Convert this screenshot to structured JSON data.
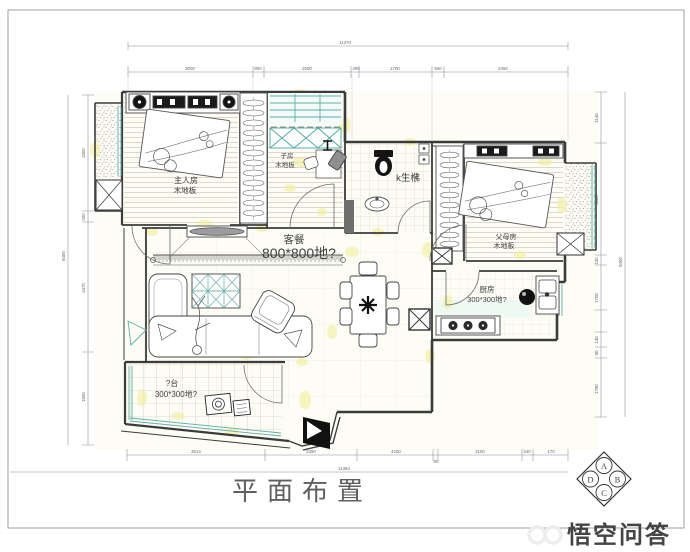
{
  "page": {
    "title_block": {
      "drawing_title": "平面布置"
    },
    "watermark": "悟空问答"
  },
  "rooms": {
    "master": {
      "name": "主人房",
      "floor": "木地板"
    },
    "kids": {
      "name": "子房",
      "floor": "木地板"
    },
    "bathroom": {
      "name": "k生梻"
    },
    "parents": {
      "name": "父母房",
      "floor": "木地板"
    },
    "living_dining": {
      "name": "客餐",
      "floor": "800*800地?"
    },
    "kitchen": {
      "name": "厨房",
      "floor": "300*300地?"
    },
    "balcony": {
      "name": "?台",
      "floor": "300*300地?"
    }
  },
  "dimensions": {
    "top": {
      "total": "11370",
      "segments": [
        "3000",
        "800",
        "2500",
        "300",
        "1700",
        "940",
        "2450"
      ]
    },
    "bottom": {
      "total": "11384",
      "segments": [
        "3514",
        "2390",
        "4200",
        "90",
        "2150",
        "240",
        "170"
      ]
    },
    "left": {
      "total": "8400",
      "segments": [
        "3300",
        "200",
        "3470",
        "1800"
      ]
    },
    "right": {
      "total": "8400",
      "segments": [
        "1140",
        "3000",
        "130",
        "1700",
        "140",
        "90",
        "1780"
      ]
    }
  },
  "reference_symbol": {
    "top": "A",
    "right": "B",
    "bottom": "C",
    "left": "D"
  },
  "colors": {
    "title_teal": "#49a9a1",
    "window_teal": "#5fb0a9",
    "highlight_yellow": "#f3ef9a",
    "wall_dark": "#3b3b3b",
    "watermark_gray": "#ededed"
  }
}
